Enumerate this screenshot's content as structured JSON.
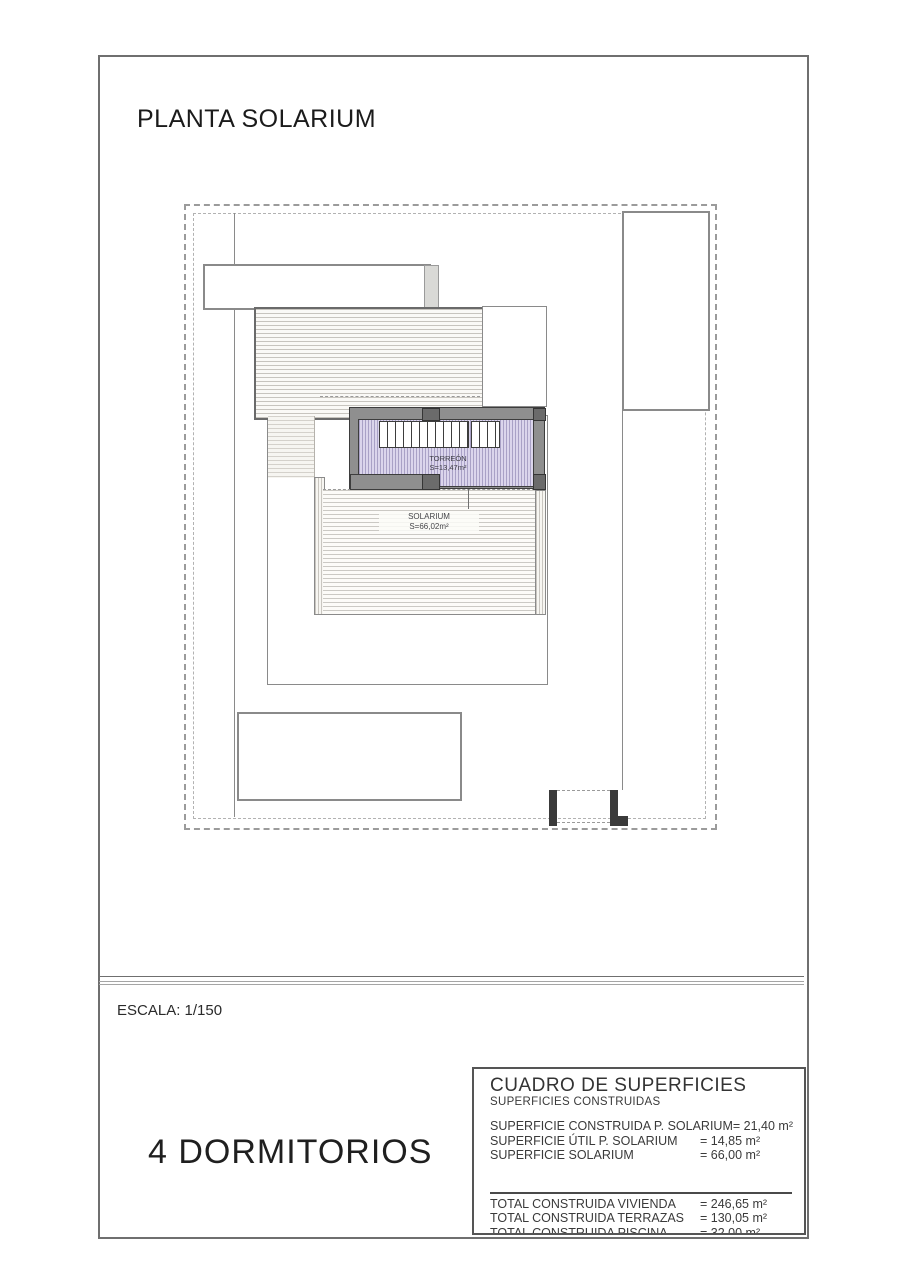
{
  "page": {
    "title": "PLANTA SOLARIUM",
    "scale_label": "ESCALA: 1/150",
    "bedrooms_label": "4 DORMITORIOS"
  },
  "plan": {
    "torreon": {
      "name": "TORREÓN",
      "area": "S=13,47m²"
    },
    "solarium": {
      "name": "SOLARIUM",
      "area": "S=66,02m²"
    }
  },
  "surfaces_table": {
    "title": "CUADRO DE SUPERFICIES",
    "subtitle": "SUPERFICIES CONSTRUIDAS",
    "rows": [
      {
        "label": "SUPERFICIE CONSTRUIDA P. SOLARIUM",
        "value": "= 21,40 m²"
      },
      {
        "label": "SUPERFICIE ÚTIL P. SOLARIUM",
        "value": "= 14,85 m²"
      },
      {
        "label": "SUPERFICIE SOLARIUM",
        "value": "= 66,00 m²"
      }
    ],
    "totals": [
      {
        "label": "TOTAL CONSTRUIDA VIVIENDA",
        "value": "= 246,65 m²"
      },
      {
        "label": "TOTAL CONSTRUIDA TERRAZAS",
        "value": "= 130,05 m²"
      },
      {
        "label": "TOTAL CONSTRUIDA PISCINA",
        "value": "= 32,00 m²"
      }
    ]
  },
  "colors": {
    "torreon_fill": "#dbd5ec",
    "torreon_hatch": "#a9a1c6",
    "wall_gray": "#8f8f8f",
    "wall_dark": "#3d3d3d",
    "hatch_line": "#c7c4be",
    "boundary_dash": "#9b9b9b"
  }
}
